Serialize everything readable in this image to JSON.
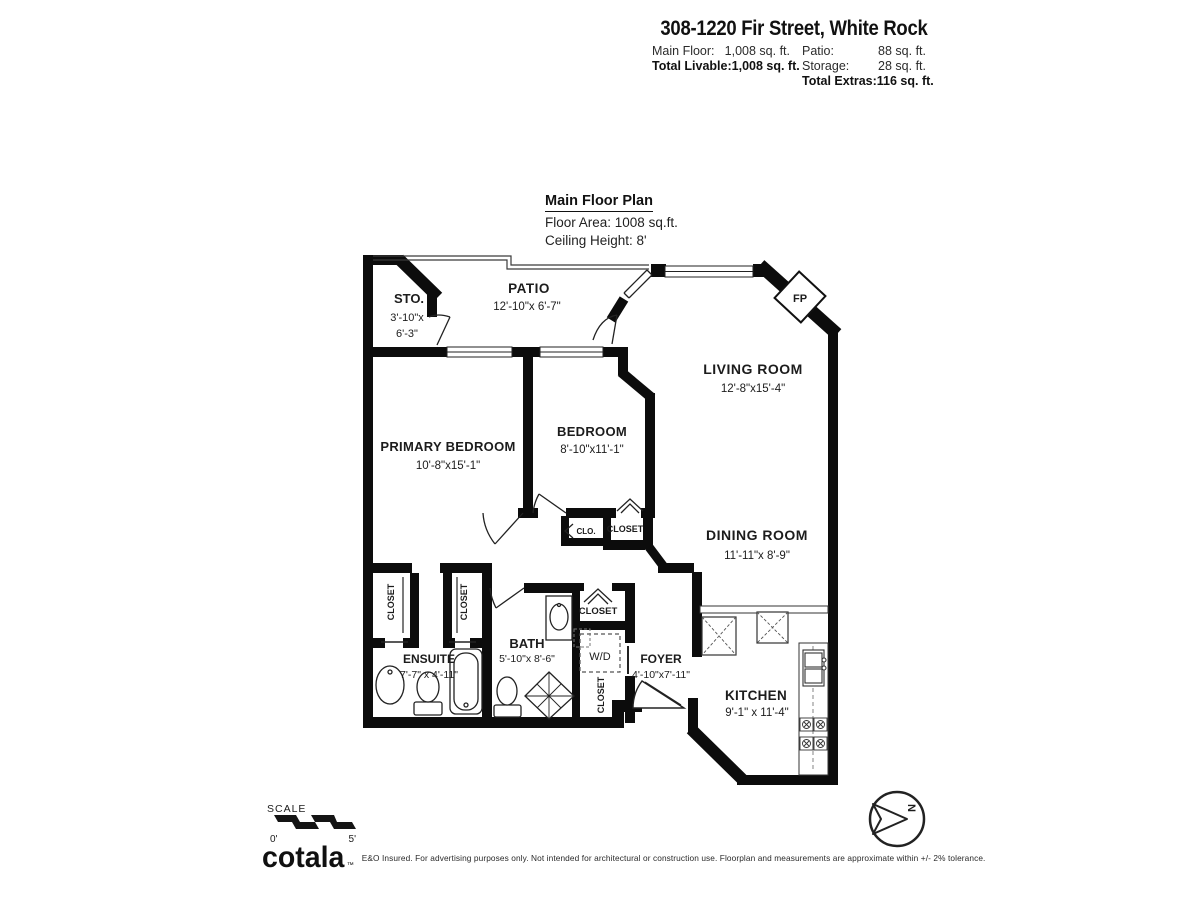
{
  "header": {
    "title": "308-1220 Fir Street, White Rock",
    "stats_left": [
      {
        "label": "Main Floor:",
        "value": "1,008 sq. ft."
      },
      {
        "label": "Total Livable:",
        "value": "1,008 sq. ft."
      }
    ],
    "stats_right": [
      {
        "label": "Patio:",
        "value": "88 sq. ft."
      },
      {
        "label": "Storage:",
        "value": "28 sq. ft."
      },
      {
        "label": "Total Extras:",
        "value": "116 sq. ft."
      }
    ]
  },
  "plan_header": {
    "title": "Main Floor Plan",
    "floor_area": "Floor Area: 1008 sq.ft.",
    "ceiling_height": "Ceiling Height: 8'"
  },
  "rooms": {
    "storage": {
      "name": "STO.",
      "dims1": "3'-10\"x",
      "dims2": "6'-3\""
    },
    "patio": {
      "name": "PATIO",
      "dims": "12'-10\"x 6'-7\""
    },
    "living_room": {
      "name": "LIVING ROOM",
      "dims": "12'-8\"x15'-4\""
    },
    "primary_bedroom": {
      "name": "PRIMARY BEDROOM",
      "dims": "10'-8\"x15'-1\""
    },
    "bedroom": {
      "name": "BEDROOM",
      "dims": "8'-10\"x11'-1\""
    },
    "dining_room": {
      "name": "DINING ROOM",
      "dims": "11'-11\"x 8'-9\""
    },
    "ensuite": {
      "name": "ENSUITE",
      "dims": "7'-7\" x 4'-11\""
    },
    "bath": {
      "name": "BATH",
      "dims": "5'-10\"x 8'-6\""
    },
    "foyer": {
      "name": "FOYER",
      "dims": "4'-10\"x7'-11\""
    },
    "kitchen": {
      "name": "KITCHEN",
      "dims": "9'-1\" x 11'-4\""
    }
  },
  "labels": {
    "fireplace": "FP",
    "washer_dryer": "W/D",
    "closet": "CLOSET",
    "closet_small": "CLO."
  },
  "scale_bar": {
    "label": "SCALE",
    "start": "0'",
    "end": "5'"
  },
  "compass": {
    "north": "N"
  },
  "colors": {
    "wall": "#0c0c0c",
    "line": "#222222",
    "text": "#1c1c1c"
  },
  "footer": {
    "brand": "cotala",
    "trademark": "™",
    "disclaimer": "E&O Insured. For advertising purposes only. Not intended for architectural or construction use. Floorplan and measurements are approximate within +/- 2% tolerance."
  }
}
